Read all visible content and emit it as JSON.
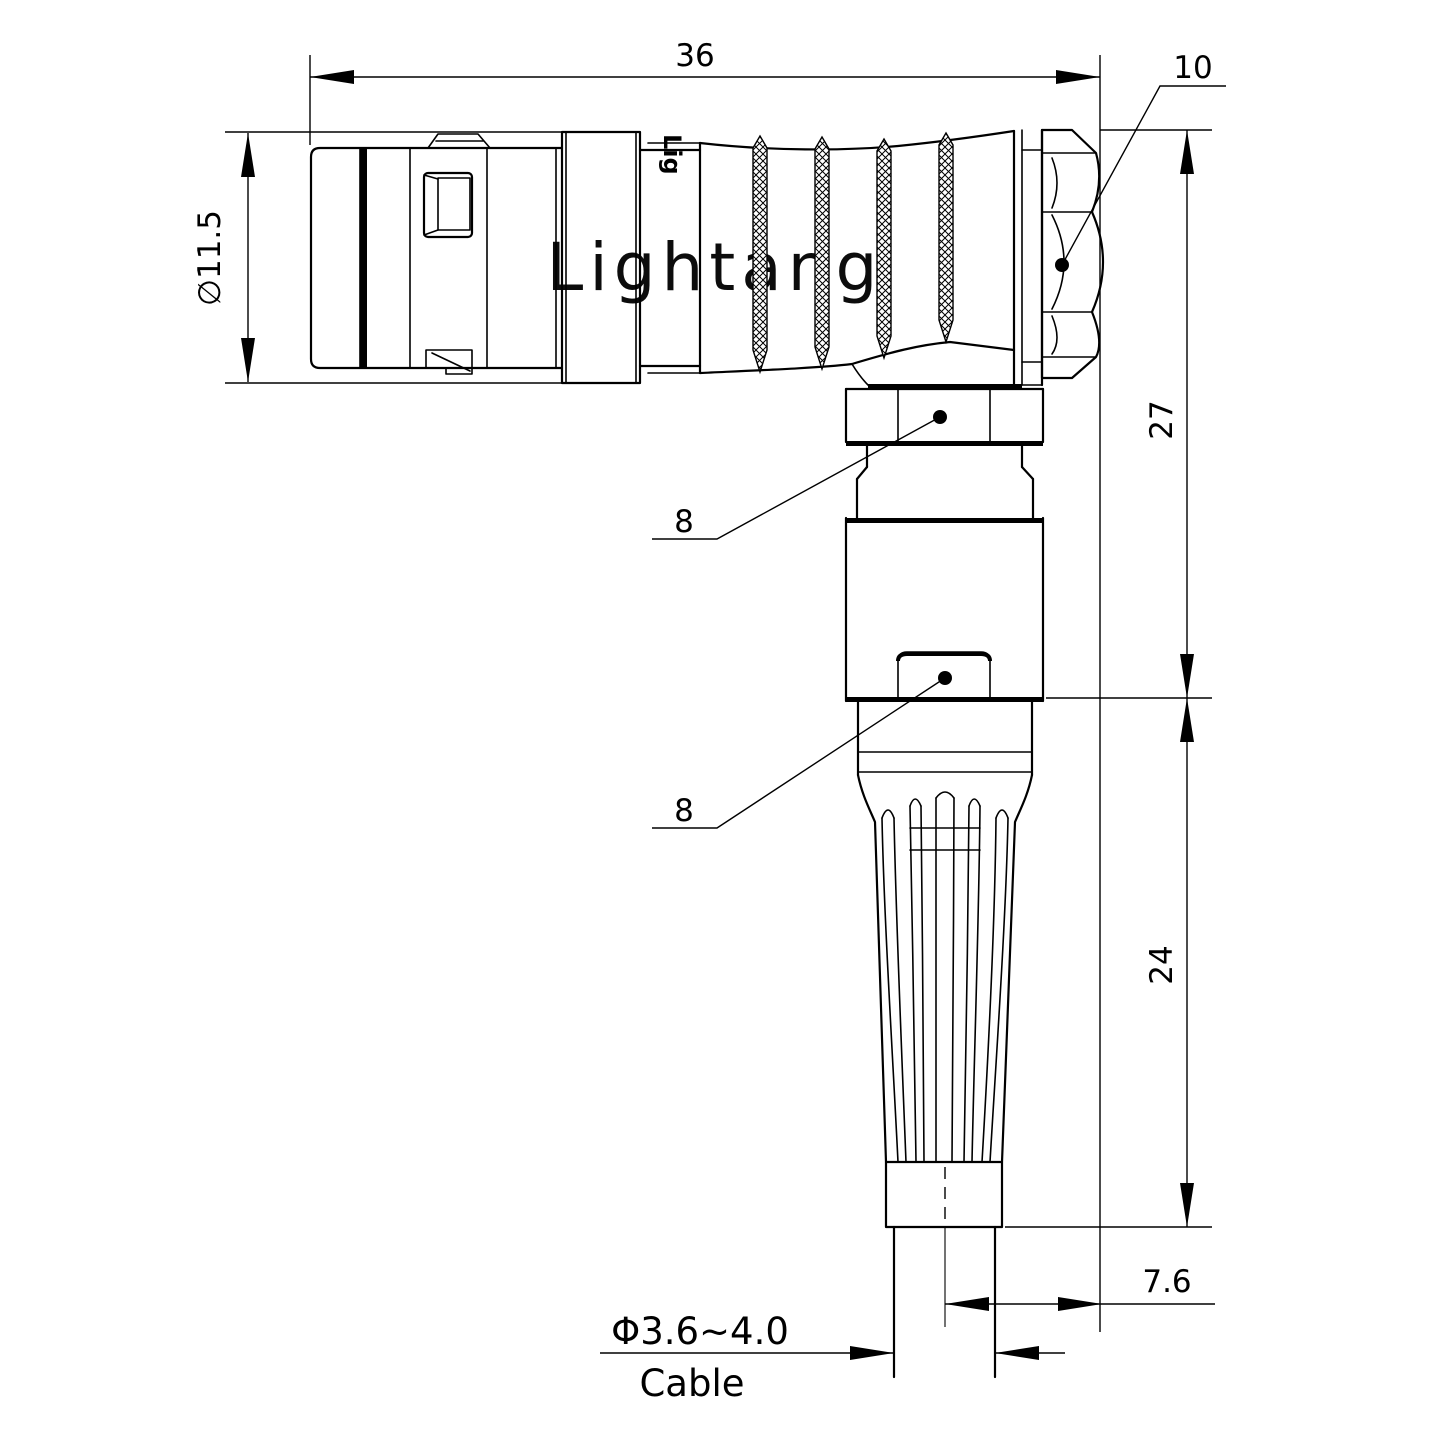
{
  "watermark": {
    "text": "Lightang",
    "partial": "Lig",
    "color": "#f2c0c0"
  },
  "drawing": {
    "line_color": "#000000",
    "background": "#ffffff",
    "subject": "right-angle push-pull connector with bend relief, side view"
  },
  "dimensions": {
    "overall_length": "36",
    "nut_across_flats": "10",
    "coupling_diameter": "∅11.5",
    "elbow_height": "27",
    "strain_relief_height": "24",
    "gland_nut_label": "8",
    "boss_label": "8",
    "cable_exit_offset": "7.6",
    "cable_range": "Φ3.6~4.0",
    "cable_label": "Cable"
  }
}
